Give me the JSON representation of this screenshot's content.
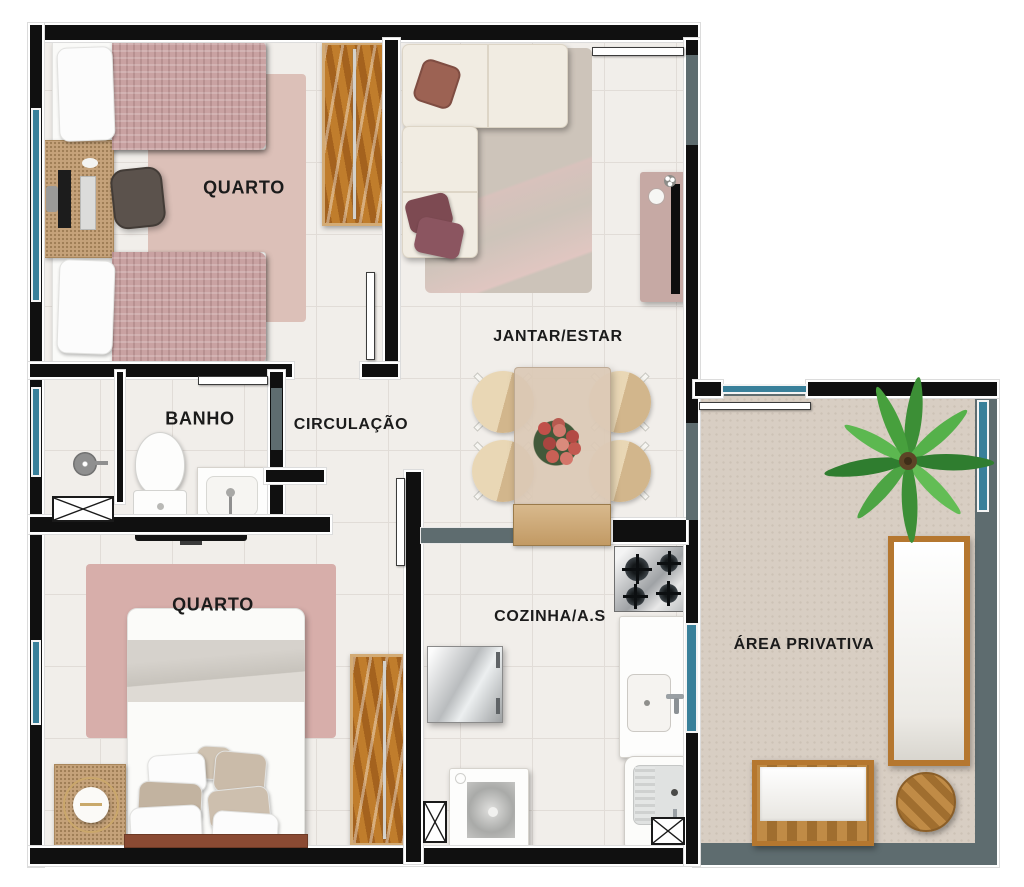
{
  "floor_plan": {
    "rooms": {
      "bedroom1": {
        "label": "QUARTO"
      },
      "living_dining": {
        "label": "JANTAR/ESTAR"
      },
      "bathroom": {
        "label": "BANHO"
      },
      "hallway": {
        "label": "CIRCULAÇÃO"
      },
      "bedroom2": {
        "label": "QUARTO"
      },
      "kitchen_service": {
        "label": "COZINHA/A.S"
      },
      "private_area": {
        "label": "ÁREA PRIVATIVA"
      }
    },
    "colors": {
      "wall": "#101010",
      "window_glass": "#39809a",
      "tile_floor": "#f1eeea",
      "private_area_floor": "#d8cec3",
      "private_area_wall": "#5e6c6f",
      "wood": "#b8762c",
      "rug_pink": "#d9bcb4",
      "sofa_cream": "#f1ece2",
      "tv_console_mauve": "#c6a9a4"
    }
  }
}
